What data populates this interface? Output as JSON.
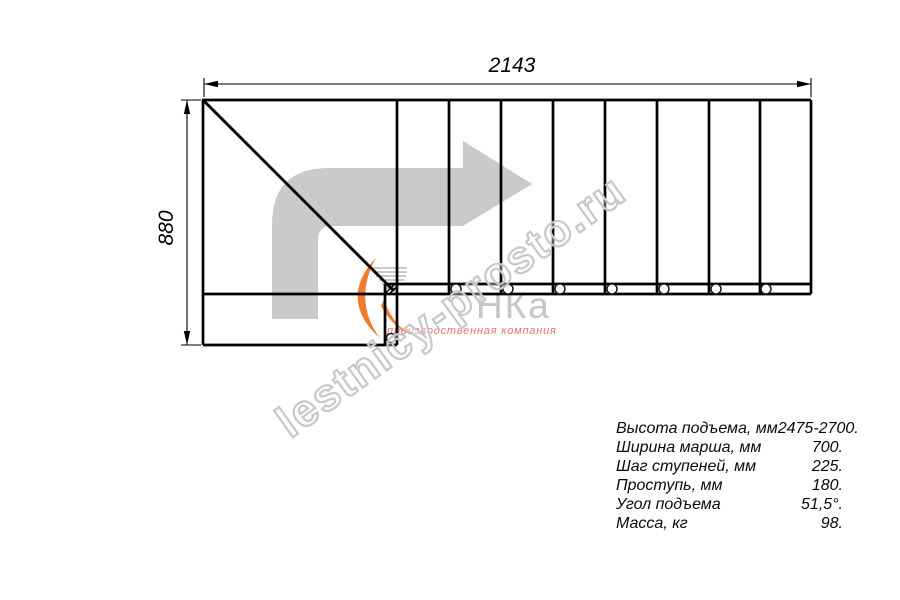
{
  "dimensions": {
    "width_label": "2143",
    "height_label": "880"
  },
  "specs": {
    "rows": [
      {
        "label": "Высота подъема, мм",
        "value": "2475-2700."
      },
      {
        "label": "Ширина марша, мм",
        "value": "700."
      },
      {
        "label": "Шаг ступеней, мм",
        "value": "225."
      },
      {
        "label": "Проступь, мм",
        "value": "180."
      },
      {
        "label": "Угол подъема",
        "value": "51,5°."
      },
      {
        "label": "Масса, кг",
        "value": "98."
      }
    ]
  },
  "watermark": {
    "site_text": "lestnicy-prosto.ru",
    "logo_text": "НКа",
    "logo_tagline": "производственная компания"
  },
  "colors": {
    "line_black": "#000000",
    "arrow_gray": "#cacaca",
    "watermark_gray": "#c8c8c8",
    "logo_gray": "#c5c5c5",
    "logo_orange": "#f07a2e",
    "tagline_red": "#e0756b"
  }
}
